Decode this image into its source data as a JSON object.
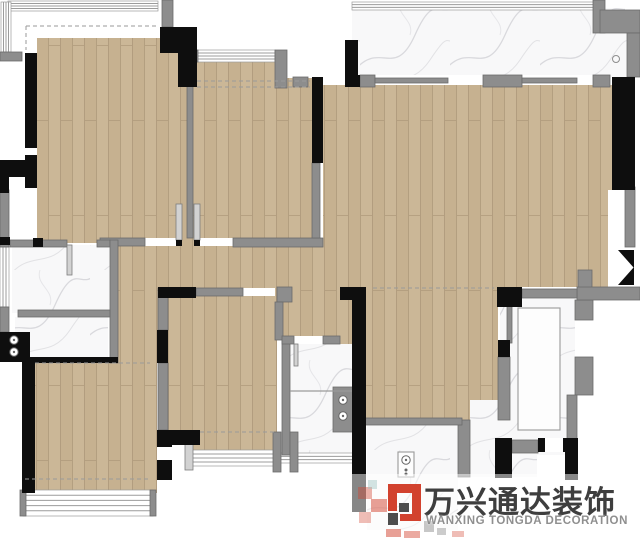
{
  "canvas": {
    "width": 640,
    "height": 539,
    "background": "#ffffff"
  },
  "palette": {
    "wood": "#c6b190",
    "wood_light": "#cfbb9c",
    "wood_stripe": "#ad987a",
    "wall_black": "#0e0e0e",
    "wall_gray": "#8d8d8d",
    "wall_gray_edge": "#6b6b6b",
    "frame_light": "#d2d2d2",
    "frame_edge": "#7d7d7d",
    "marble": "#f8f8f9",
    "marble_vein": "#d4d4d8",
    "window_line": "#9c9c9c",
    "dash": "#9a9a9a",
    "white": "#ffffff",
    "fixture_stroke": "#666666"
  },
  "plan": {
    "wood": [
      [
        37,
        38,
        150,
        205
      ],
      [
        193,
        62,
        119,
        176
      ],
      [
        323,
        85,
        289,
        165
      ],
      [
        118,
        238,
        380,
        62
      ],
      [
        498,
        238,
        110,
        49
      ],
      [
        168,
        288,
        109,
        162
      ],
      [
        283,
        296,
        74,
        48
      ],
      [
        357,
        296,
        141,
        124
      ],
      [
        35,
        360,
        122,
        133
      ],
      [
        118,
        300,
        40,
        63
      ]
    ],
    "marble": [
      [
        352,
        8,
        273,
        67
      ],
      [
        600,
        33,
        27,
        44
      ],
      [
        12,
        245,
        98,
        68
      ],
      [
        15,
        317,
        93,
        43
      ],
      [
        288,
        344,
        64,
        111
      ],
      [
        500,
        288,
        75,
        167
      ],
      [
        367,
        425,
        91,
        105
      ],
      [
        470,
        400,
        67,
        77
      ]
    ],
    "white": [
      [
        287,
        52,
        58,
        26
      ],
      [
        608,
        190,
        32,
        97
      ],
      [
        145,
        238,
        31,
        8
      ],
      [
        200,
        238,
        33,
        8
      ],
      [
        243,
        288,
        32,
        8
      ],
      [
        294,
        336,
        29,
        8
      ],
      [
        168,
        445,
        17,
        25
      ],
      [
        25,
        148,
        12,
        7
      ],
      [
        545,
        438,
        18,
        14
      ],
      [
        610,
        247,
        30,
        40
      ]
    ],
    "windows": [
      {
        "r": [
          8,
          1,
          150,
          10
        ],
        "dir": "h",
        "n": 4
      },
      {
        "r": [
          1,
          2,
          10,
          50
        ],
        "dir": "v",
        "n": 4
      },
      {
        "r": [
          197,
          50,
          78,
          12
        ],
        "dir": "h",
        "n": 4
      },
      {
        "r": [
          352,
          2,
          248,
          8
        ],
        "dir": "h",
        "n": 3
      },
      {
        "r": [
          0,
          247,
          9,
          60
        ],
        "dir": "v",
        "n": 3
      },
      {
        "r": [
          23,
          490,
          130,
          26
        ],
        "dir": "h",
        "n": 5
      },
      {
        "r": [
          188,
          450,
          92,
          16
        ],
        "dir": "h",
        "n": 4
      },
      {
        "r": [
          280,
          453,
          76,
          10
        ],
        "dir": "h",
        "n": 3
      }
    ],
    "gray": [
      [
        162,
        0,
        11,
        27
      ],
      [
        0,
        52,
        22,
        9
      ],
      [
        187,
        85,
        6,
        153
      ],
      [
        100,
        238,
        45,
        8
      ],
      [
        233,
        238,
        90,
        9
      ],
      [
        312,
        163,
        8,
        75
      ],
      [
        275,
        50,
        12,
        38
      ],
      [
        293,
        77,
        15,
        10
      ],
      [
        360,
        75,
        15,
        12
      ],
      [
        483,
        75,
        39,
        12
      ],
      [
        593,
        75,
        17,
        12
      ],
      [
        375,
        78,
        73,
        5
      ],
      [
        522,
        78,
        55,
        5
      ],
      [
        593,
        0,
        12,
        33
      ],
      [
        600,
        10,
        40,
        23
      ],
      [
        627,
        33,
        13,
        44
      ],
      [
        10,
        240,
        57,
        7
      ],
      [
        97,
        240,
        13,
        7
      ],
      [
        110,
        240,
        8,
        123
      ],
      [
        18,
        310,
        92,
        7
      ],
      [
        0,
        190,
        9,
        57
      ],
      [
        0,
        307,
        9,
        25
      ],
      [
        158,
        288,
        10,
        42
      ],
      [
        158,
        363,
        10,
        67
      ],
      [
        196,
        288,
        47,
        8
      ],
      [
        277,
        287,
        15,
        15
      ],
      [
        275,
        302,
        8,
        38
      ],
      [
        282,
        340,
        8,
        115
      ],
      [
        282,
        336,
        12,
        8
      ],
      [
        323,
        336,
        17,
        8
      ],
      [
        333,
        387,
        20,
        45
      ],
      [
        273,
        432,
        8,
        40
      ],
      [
        290,
        432,
        8,
        40
      ],
      [
        458,
        420,
        12,
        57
      ],
      [
        362,
        418,
        100,
        7
      ],
      [
        507,
        305,
        5,
        38
      ],
      [
        578,
        270,
        14,
        27
      ],
      [
        575,
        300,
        18,
        20
      ],
      [
        575,
        357,
        18,
        38
      ],
      [
        567,
        395,
        10,
        45
      ],
      [
        577,
        287,
        63,
        13
      ],
      [
        498,
        357,
        12,
        63
      ],
      [
        625,
        187,
        10,
        60
      ],
      [
        512,
        440,
        26,
        13
      ],
      [
        522,
        289,
        55,
        9
      ],
      [
        193,
        50,
        5,
        12
      ],
      [
        20,
        490,
        6,
        26
      ],
      [
        150,
        490,
        6,
        26
      ]
    ],
    "frames": [
      [
        176,
        204,
        6,
        36
      ],
      [
        194,
        204,
        6,
        36
      ],
      [
        67,
        245,
        5,
        30
      ],
      [
        294,
        344,
        4,
        22
      ],
      [
        185,
        443,
        8,
        27
      ]
    ],
    "black": [
      [
        160,
        27,
        37,
        26
      ],
      [
        178,
        53,
        19,
        34
      ],
      [
        25,
        53,
        12,
        95
      ],
      [
        25,
        155,
        12,
        33
      ],
      [
        0,
        160,
        37,
        17
      ],
      [
        0,
        177,
        9,
        16
      ],
      [
        0,
        237,
        10,
        8
      ],
      [
        33,
        238,
        10,
        9
      ],
      [
        0,
        332,
        30,
        30
      ],
      [
        22,
        357,
        96,
        6
      ],
      [
        22,
        360,
        13,
        133
      ],
      [
        158,
        287,
        38,
        11
      ],
      [
        157,
        330,
        11,
        33
      ],
      [
        157,
        430,
        15,
        17
      ],
      [
        172,
        430,
        28,
        15
      ],
      [
        157,
        460,
        15,
        20
      ],
      [
        312,
        77,
        11,
        86
      ],
      [
        345,
        40,
        13,
        45
      ],
      [
        345,
        75,
        15,
        12
      ],
      [
        612,
        77,
        23,
        113
      ],
      [
        497,
        287,
        25,
        20
      ],
      [
        498,
        340,
        12,
        17
      ],
      [
        340,
        287,
        23,
        13
      ],
      [
        352,
        287,
        14,
        225
      ],
      [
        495,
        438,
        17,
        40
      ],
      [
        538,
        438,
        7,
        14
      ],
      [
        563,
        438,
        15,
        14
      ],
      [
        565,
        450,
        13,
        30
      ],
      [
        176,
        240,
        6,
        6
      ],
      [
        194,
        240,
        6,
        6
      ]
    ],
    "dashed": [
      [
        26,
        26,
        157,
        26
      ],
      [
        26,
        26,
        26,
        50
      ],
      [
        197,
        81,
        310,
        81
      ],
      [
        197,
        87,
        310,
        87
      ],
      [
        35,
        363,
        150,
        363
      ],
      [
        25,
        479,
        148,
        479
      ],
      [
        200,
        432,
        277,
        432
      ],
      [
        373,
        288,
        494,
        288
      ]
    ],
    "lines": [
      [
        290,
        391,
        352,
        391
      ]
    ],
    "outlines": [
      [
        518,
        308,
        42,
        122
      ],
      [
        398,
        452,
        16,
        25
      ]
    ],
    "knobs": [
      [
        14,
        340
      ],
      [
        14,
        352
      ],
      [
        343,
        400
      ],
      [
        343,
        416
      ],
      [
        406,
        460
      ]
    ],
    "dots": [
      [
        406,
        470
      ],
      [
        406,
        474
      ]
    ],
    "drain": [
      616,
      59
    ],
    "door_triangles": [
      "618,250 634,250 634,268",
      "618,285 634,285 634,267"
    ]
  },
  "logo": {
    "cn": "万兴通达装饰",
    "en": "WANXING TONGDA DECORATION",
    "backdrop": [
      350,
      474,
      290,
      64
    ],
    "colors": {
      "red": "#d2422e",
      "gray": "#8f8f8f",
      "teal": "#9fc6c4",
      "dark": "#4d4d4d",
      "text": "#3e3e3e",
      "sub": "#8f8f8f"
    },
    "squares": [
      [
        358,
        487,
        14,
        12,
        "red",
        0.4
      ],
      [
        371,
        499,
        16,
        13,
        "red",
        0.5
      ],
      [
        359,
        512,
        12,
        11,
        "red",
        0.35
      ],
      [
        386,
        529,
        15,
        8,
        "red",
        0.5
      ],
      [
        404,
        531,
        16,
        7,
        "red",
        0.45
      ],
      [
        424,
        521,
        10,
        11,
        "gray",
        0.5
      ],
      [
        437,
        528,
        9,
        7,
        "gray",
        0.45
      ],
      [
        368,
        480,
        9,
        9,
        "teal",
        0.45
      ],
      [
        452,
        531,
        12,
        6,
        "red",
        0.35
      ]
    ],
    "icon": [
      [
        388,
        484,
        33,
        9,
        "red"
      ],
      [
        412,
        493,
        9,
        28,
        "red"
      ],
      [
        388,
        493,
        9,
        18,
        "red"
      ],
      [
        399,
        503,
        10,
        9,
        "dark"
      ],
      [
        388,
        513,
        10,
        12,
        "dark"
      ],
      [
        400,
        514,
        21,
        7,
        "red"
      ]
    ]
  }
}
